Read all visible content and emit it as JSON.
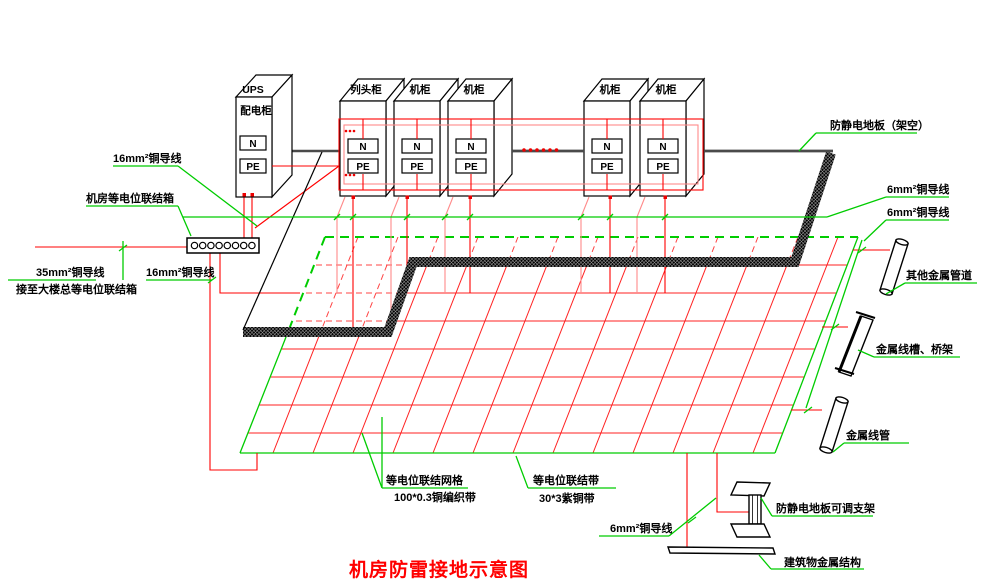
{
  "title": "机房防雷接地示意图",
  "cabinets": {
    "ups_line1": "UPS",
    "ups_line2": "配电柜",
    "row": [
      "列头柜",
      "机柜",
      "机柜",
      "机柜",
      "机柜"
    ],
    "n": "N",
    "pe": "PE"
  },
  "labels": {
    "wire16_top": "16mm²铜导线",
    "bonding_box": "机房等电位联结箱",
    "wire35": "35mm²铜导线",
    "to_building": "接至大楼总等电位联结箱",
    "wire16_mid": "16mm²铜导线",
    "floor": "防静电地板（架空）",
    "wire6_a": "6mm²铜导线",
    "wire6_b": "6mm²铜导线",
    "other_pipes": "其他金属管道",
    "cable_tray": "金属线槽、桥架",
    "conduit": "金属线管",
    "grid_line1": "等电位联结网格",
    "grid_line2": "100*0.3铜编织带",
    "belt_line1": "等电位联结带",
    "belt_line2": "30*3紫铜带",
    "wire6_bottom": "6mm²铜导线",
    "bracket": "防静电地板可调支架",
    "structure": "建筑物金属结构"
  },
  "colors": {
    "wire_red": "#ff0000",
    "leader_green": "#00cc00",
    "floor_gray": "#4a4a4a",
    "title_red": "#ff0000"
  }
}
